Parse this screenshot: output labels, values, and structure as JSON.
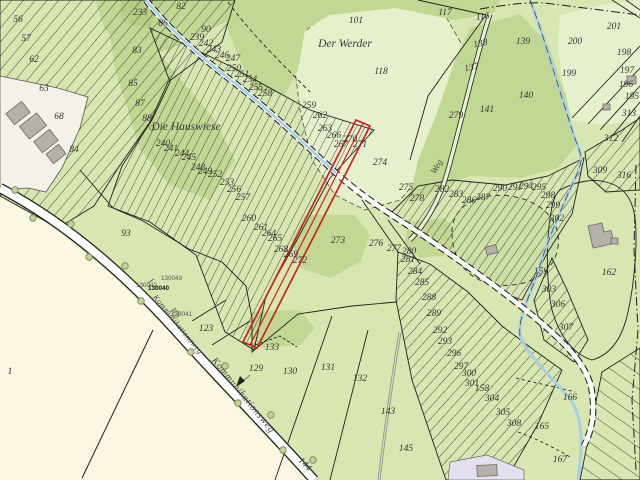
{
  "map": {
    "type": "cadastral-parcel-map",
    "place_names": [
      "Der Werder",
      "Die Hauswiese"
    ],
    "road_names": [
      "Kommunikationsweg",
      "Weg"
    ],
    "survey_point_numbers": [
      "130040",
      "130041",
      "130042",
      "130043"
    ],
    "highlighted_parcel_color": "#cf2020",
    "labels": [
      {
        "t": "56",
        "x": 18,
        "y": 22
      },
      {
        "t": "57",
        "x": 26,
        "y": 41
      },
      {
        "t": "62",
        "x": 34,
        "y": 62
      },
      {
        "t": "63",
        "x": 44,
        "y": 91
      },
      {
        "t": "68",
        "x": 59,
        "y": 119
      },
      {
        "t": "84",
        "x": 74,
        "y": 152
      },
      {
        "t": "93",
        "x": 126,
        "y": 236
      },
      {
        "t": "1",
        "x": 10,
        "y": 374
      },
      {
        "t": "233",
        "x": 140,
        "y": 15
      },
      {
        "t": "82",
        "x": 181,
        "y": 9
      },
      {
        "t": "86",
        "x": 163,
        "y": 26
      },
      {
        "t": "90",
        "x": 206,
        "y": 32
      },
      {
        "t": "83",
        "x": 137,
        "y": 53
      },
      {
        "t": "85",
        "x": 133,
        "y": 86
      },
      {
        "t": "87",
        "x": 140,
        "y": 106
      },
      {
        "t": "88",
        "x": 147,
        "y": 121
      },
      {
        "t": "101",
        "x": 356,
        "y": 23
      },
      {
        "t": "117",
        "x": 445,
        "y": 15
      },
      {
        "t": "116",
        "x": 483,
        "y": 19,
        "rot": -8
      },
      {
        "t": "138",
        "x": 481,
        "y": 46,
        "rot": -12
      },
      {
        "t": "137",
        "x": 472,
        "y": 70,
        "rot": -12
      },
      {
        "t": "139",
        "x": 523,
        "y": 44
      },
      {
        "t": "200",
        "x": 575,
        "y": 44
      },
      {
        "t": "201",
        "x": 614,
        "y": 29
      },
      {
        "t": "198",
        "x": 624,
        "y": 55
      },
      {
        "t": "197",
        "x": 627,
        "y": 73
      },
      {
        "t": "196",
        "x": 626,
        "y": 87
      },
      {
        "t": "195",
        "x": 632,
        "y": 99
      },
      {
        "t": "199",
        "x": 569,
        "y": 76
      },
      {
        "t": "140",
        "x": 526,
        "y": 98
      },
      {
        "t": "141",
        "x": 487,
        "y": 112
      },
      {
        "t": "279",
        "x": 456,
        "y": 118
      },
      {
        "t": "118",
        "x": 381,
        "y": 74
      },
      {
        "t": "313",
        "x": 629,
        "y": 116
      },
      {
        "t": "312",
        "x": 611,
        "y": 141
      },
      {
        "t": "309",
        "x": 600,
        "y": 173
      },
      {
        "t": "316",
        "x": 624,
        "y": 178
      },
      {
        "t": "239",
        "x": 197,
        "y": 40
      },
      {
        "t": "242",
        "x": 206,
        "y": 46
      },
      {
        "t": "243",
        "x": 214,
        "y": 52
      },
      {
        "t": "246",
        "x": 222,
        "y": 58
      },
      {
        "t": "247",
        "x": 233,
        "y": 61
      },
      {
        "t": "250",
        "x": 234,
        "y": 71
      },
      {
        "t": "251",
        "x": 242,
        "y": 77
      },
      {
        "t": "254",
        "x": 250,
        "y": 82
      },
      {
        "t": "255",
        "x": 256,
        "y": 90
      },
      {
        "t": "258",
        "x": 265,
        "y": 96
      },
      {
        "t": "259",
        "x": 309,
        "y": 108
      },
      {
        "t": "262",
        "x": 320,
        "y": 118
      },
      {
        "t": "263",
        "x": 325,
        "y": 131
      },
      {
        "t": "266",
        "x": 334,
        "y": 138
      },
      {
        "t": "267",
        "x": 341,
        "y": 147
      },
      {
        "t": "270",
        "x": 350,
        "y": 142
      },
      {
        "t": "271",
        "x": 360,
        "y": 147
      },
      {
        "t": "240",
        "x": 163,
        "y": 146
      },
      {
        "t": "241",
        "x": 171,
        "y": 151
      },
      {
        "t": "244",
        "x": 182,
        "y": 156
      },
      {
        "t": "245",
        "x": 189,
        "y": 160
      },
      {
        "t": "248",
        "x": 198,
        "y": 170
      },
      {
        "t": "249",
        "x": 205,
        "y": 174
      },
      {
        "t": "252",
        "x": 215,
        "y": 177
      },
      {
        "t": "253",
        "x": 227,
        "y": 185
      },
      {
        "t": "256",
        "x": 234,
        "y": 192
      },
      {
        "t": "257",
        "x": 243,
        "y": 200
      },
      {
        "t": "260",
        "x": 249,
        "y": 221
      },
      {
        "t": "261",
        "x": 261,
        "y": 230
      },
      {
        "t": "264",
        "x": 269,
        "y": 236
      },
      {
        "t": "265",
        "x": 275,
        "y": 241
      },
      {
        "t": "268",
        "x": 281,
        "y": 252
      },
      {
        "t": "269",
        "x": 291,
        "y": 257
      },
      {
        "t": "272",
        "x": 300,
        "y": 263
      },
      {
        "t": "274",
        "x": 380,
        "y": 165
      },
      {
        "t": "275",
        "x": 406,
        "y": 190
      },
      {
        "t": "278",
        "x": 417,
        "y": 201
      },
      {
        "t": "273",
        "x": 338,
        "y": 243
      },
      {
        "t": "276",
        "x": 376,
        "y": 246
      },
      {
        "t": "277",
        "x": 394,
        "y": 251
      },
      {
        "t": "280",
        "x": 409,
        "y": 254
      },
      {
        "t": "281",
        "x": 408,
        "y": 262
      },
      {
        "t": "284",
        "x": 415,
        "y": 274
      },
      {
        "t": "285",
        "x": 422,
        "y": 285
      },
      {
        "t": "288",
        "x": 429,
        "y": 300
      },
      {
        "t": "289",
        "x": 434,
        "y": 316
      },
      {
        "t": "282",
        "x": 442,
        "y": 192
      },
      {
        "t": "283",
        "x": 456,
        "y": 197
      },
      {
        "t": "286",
        "x": 469,
        "y": 203
      },
      {
        "t": "287",
        "x": 483,
        "y": 200
      },
      {
        "t": "290",
        "x": 500,
        "y": 191
      },
      {
        "t": "291",
        "x": 515,
        "y": 190
      },
      {
        "t": "294",
        "x": 526,
        "y": 189
      },
      {
        "t": "295",
        "x": 539,
        "y": 190
      },
      {
        "t": "298",
        "x": 548,
        "y": 198
      },
      {
        "t": "299",
        "x": 553,
        "y": 208
      },
      {
        "t": "302",
        "x": 557,
        "y": 221
      },
      {
        "t": "162",
        "x": 609,
        "y": 275
      },
      {
        "t": "159",
        "x": 541,
        "y": 274
      },
      {
        "t": "303",
        "x": 549,
        "y": 292
      },
      {
        "t": "306",
        "x": 558,
        "y": 307
      },
      {
        "t": "307",
        "x": 566,
        "y": 330
      },
      {
        "t": "292",
        "x": 440,
        "y": 333
      },
      {
        "t": "293",
        "x": 445,
        "y": 344
      },
      {
        "t": "296",
        "x": 454,
        "y": 356
      },
      {
        "t": "297",
        "x": 461,
        "y": 369
      },
      {
        "t": "300",
        "x": 469,
        "y": 376
      },
      {
        "t": "301",
        "x": 472,
        "y": 386
      },
      {
        "t": "158",
        "x": 482,
        "y": 391
      },
      {
        "t": "304",
        "x": 492,
        "y": 401
      },
      {
        "t": "305",
        "x": 503,
        "y": 415
      },
      {
        "t": "308",
        "x": 514,
        "y": 426
      },
      {
        "t": "166",
        "x": 570,
        "y": 400
      },
      {
        "t": "165",
        "x": 542,
        "y": 429
      },
      {
        "t": "167",
        "x": 560,
        "y": 462
      },
      {
        "t": "123",
        "x": 206,
        "y": 331
      },
      {
        "t": "129",
        "x": 256,
        "y": 371
      },
      {
        "t": "133",
        "x": 272,
        "y": 350
      },
      {
        "t": "130",
        "x": 290,
        "y": 374
      },
      {
        "t": "131",
        "x": 328,
        "y": 370
      },
      {
        "t": "132",
        "x": 360,
        "y": 381
      },
      {
        "t": "143",
        "x": 388,
        "y": 414
      },
      {
        "t": "145",
        "x": 406,
        "y": 451
      },
      {
        "t": "144",
        "x": 303,
        "y": 466,
        "rot": 46
      },
      {
        "t": "Der Werder",
        "x": 345,
        "y": 47,
        "k": "place"
      },
      {
        "t": "Die Hauswiese",
        "x": 186,
        "y": 130,
        "k": "place"
      },
      {
        "t": "Kommunikationsweg",
        "x": 176,
        "y": 326,
        "rot": 51,
        "k": "road"
      },
      {
        "t": "Kommunikationsweg",
        "x": 241,
        "y": 397,
        "rot": 51,
        "k": "roadbig"
      },
      {
        "t": "Weg",
        "x": 439,
        "y": 168,
        "rot": -61,
        "k": "weg"
      },
      {
        "t": "130043",
        "x": 161,
        "y": 280,
        "k": "point"
      },
      {
        "t": "130042",
        "x": 136,
        "y": 287,
        "k": "point"
      },
      {
        "t": "130040",
        "x": 148,
        "y": 290,
        "k": "pointbold"
      },
      {
        "t": "130041",
        "x": 171,
        "y": 316,
        "k": "point"
      }
    ]
  },
  "colors": {
    "base_green": "#d8e6b2",
    "mid_green": "#c3d794",
    "dark_green": "#b7cd85",
    "pale_green": "#e7f0cd",
    "field_beige": "#fbf7e2",
    "road_white": "#ffffff",
    "built_area": "#f3f1e8",
    "building_gray": "#b5b1aa",
    "residential_purple": "#e4dfee",
    "stream_blue": "#a9cde3",
    "boundary_black": "#1f1f1f",
    "highlight_red": "#cf2020",
    "label_dark": "#333333",
    "road_label_gray": "#4a4a4a"
  }
}
